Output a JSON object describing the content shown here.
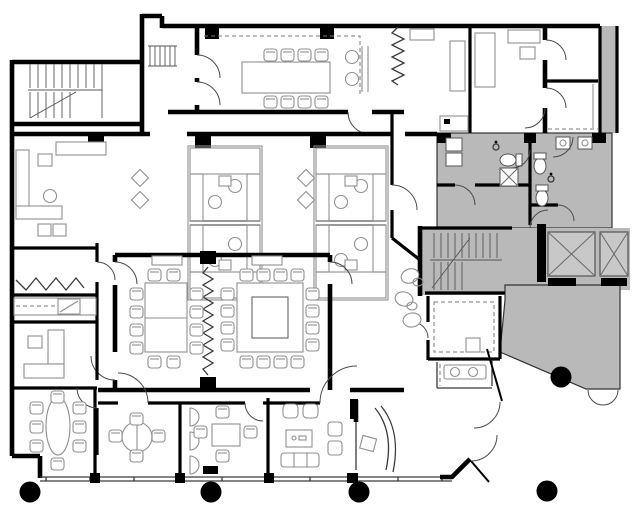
{
  "document": {
    "kind": "architectural-floor-plan",
    "visible_text": "",
    "style": "black-and-white line drawing with shaded building core"
  },
  "colors": {
    "background": "#ffffff",
    "walls": "#000000",
    "core_shading": "#b9b9b9",
    "furniture_outline": "#8f8f8f",
    "thin_partition": "#3a3a3a",
    "door_swing": "#4a4a4a",
    "dashed_line": "#7a7a7a",
    "elevator_shaft_fill": "#c8c8c8",
    "elevator_x": "#6e6e6e"
  },
  "features": {
    "round_columns": 5,
    "elevator_shafts": 2,
    "stairwells": 3,
    "large_conference_tables": 3,
    "workstation_pods": 2,
    "restrooms": {
      "toilets": 3,
      "urinals": 2,
      "sinks": 2
    },
    "shaded_zone": "building core, restrooms, elevators and public lobby"
  }
}
